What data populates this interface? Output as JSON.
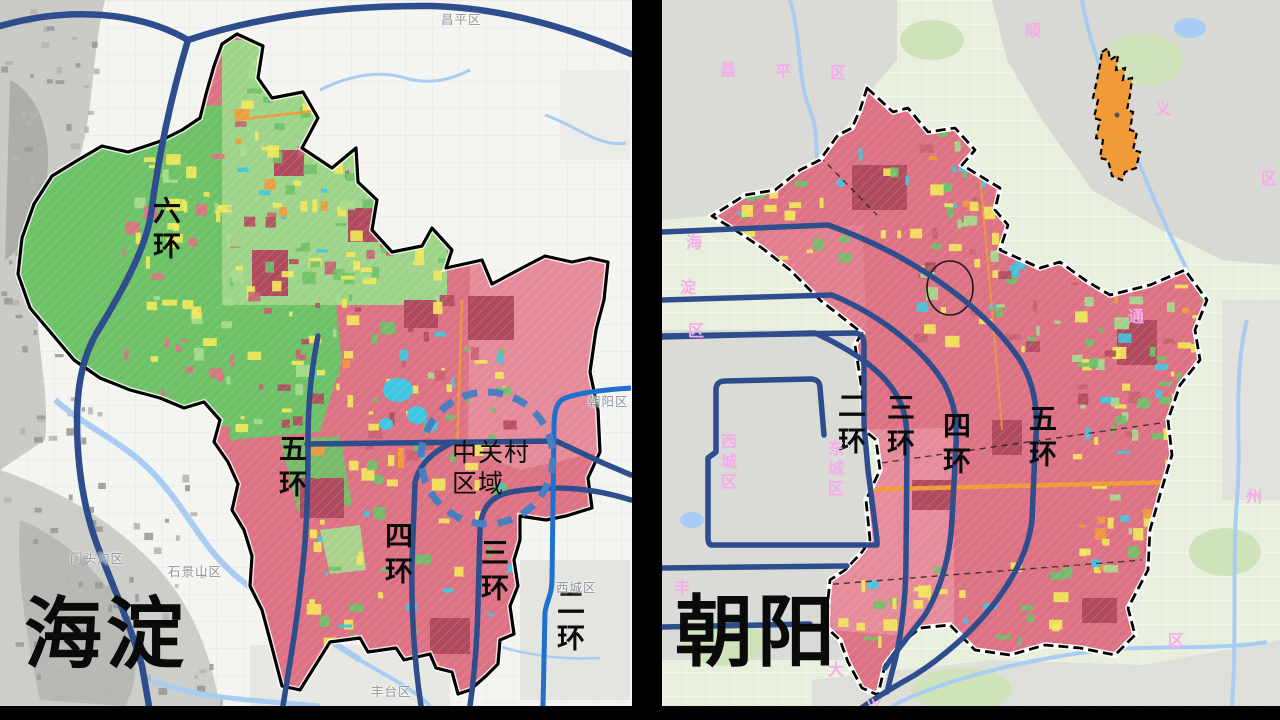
{
  "slide": {
    "description": "Beijing land-use comparison of two districts with ring roads"
  },
  "colors": {
    "ring_road": "#2e4d8c",
    "ring2_left": "#1f6fce",
    "district_fill": "#dc7283",
    "district_fill_light": "#e68e9c",
    "green": "#6dc167",
    "light_green": "#a5dd8e",
    "yellow": "#f2e95a",
    "cyan": "#3fc6e0",
    "orange": "#f09a38",
    "water": "#a9cdf2",
    "pink_label": "#f6aceb",
    "gray_label": "#8f959d",
    "boundary": "#000000",
    "dashed_circle": "#4a7ec2"
  },
  "left_map": {
    "title": "海淀",
    "ring_labels": [
      {
        "text": "六环",
        "x": 151,
        "y": 196
      },
      {
        "text": "五环",
        "x": 277,
        "y": 434
      },
      {
        "text": "四环",
        "x": 383,
        "y": 521
      },
      {
        "text": "三环",
        "x": 479,
        "y": 538
      },
      {
        "text": "二环",
        "x": 555,
        "y": 588
      }
    ],
    "district_labels": [
      {
        "text": "昌平区",
        "x": 441,
        "y": 9
      },
      {
        "text": "朝阳区",
        "x": 588,
        "y": 391
      },
      {
        "text": "门头沟区",
        "x": 70,
        "y": 548
      },
      {
        "text": "石景山区",
        "x": 168,
        "y": 561
      },
      {
        "text": "西城区",
        "x": 556,
        "y": 577
      },
      {
        "text": "丰台区",
        "x": 371,
        "y": 681
      }
    ],
    "annotation": {
      "line1": "中关村",
      "line2": "区域",
      "x": 452,
      "y": 438
    }
  },
  "right_map": {
    "title": "朝阳",
    "ring_labels": [
      {
        "text": "二环",
        "x": 174,
        "y": 391
      },
      {
        "text": "三环",
        "x": 223,
        "y": 393
      },
      {
        "text": "四环",
        "x": 279,
        "y": 411
      },
      {
        "text": "五环",
        "x": 365,
        "y": 404
      }
    ],
    "district_labels": [
      {
        "text": "昌",
        "x": 58,
        "y": 56
      },
      {
        "text": "平",
        "x": 113,
        "y": 58
      },
      {
        "text": "区",
        "x": 168,
        "y": 59
      },
      {
        "text": "顺",
        "x": 363,
        "y": 17
      },
      {
        "text": "义",
        "x": 493,
        "y": 95
      },
      {
        "text": "区",
        "x": 599,
        "y": 165
      },
      {
        "text": "海",
        "x": 24,
        "y": 229
      },
      {
        "text": "淀",
        "x": 18,
        "y": 274
      },
      {
        "text": "区",
        "x": 26,
        "y": 317
      },
      {
        "text": "西城区",
        "x": 56,
        "y": 433,
        "vertical": true
      },
      {
        "text": "东城区",
        "x": 163,
        "y": 440,
        "vertical": true
      },
      {
        "text": "丰",
        "x": 12,
        "y": 574
      },
      {
        "text": "大",
        "x": 166,
        "y": 656
      },
      {
        "text": "兴",
        "x": 204,
        "y": 693
      },
      {
        "text": "通",
        "x": 466,
        "y": 303
      },
      {
        "text": "州",
        "x": 584,
        "y": 483
      },
      {
        "text": "区",
        "x": 506,
        "y": 627
      }
    ]
  }
}
